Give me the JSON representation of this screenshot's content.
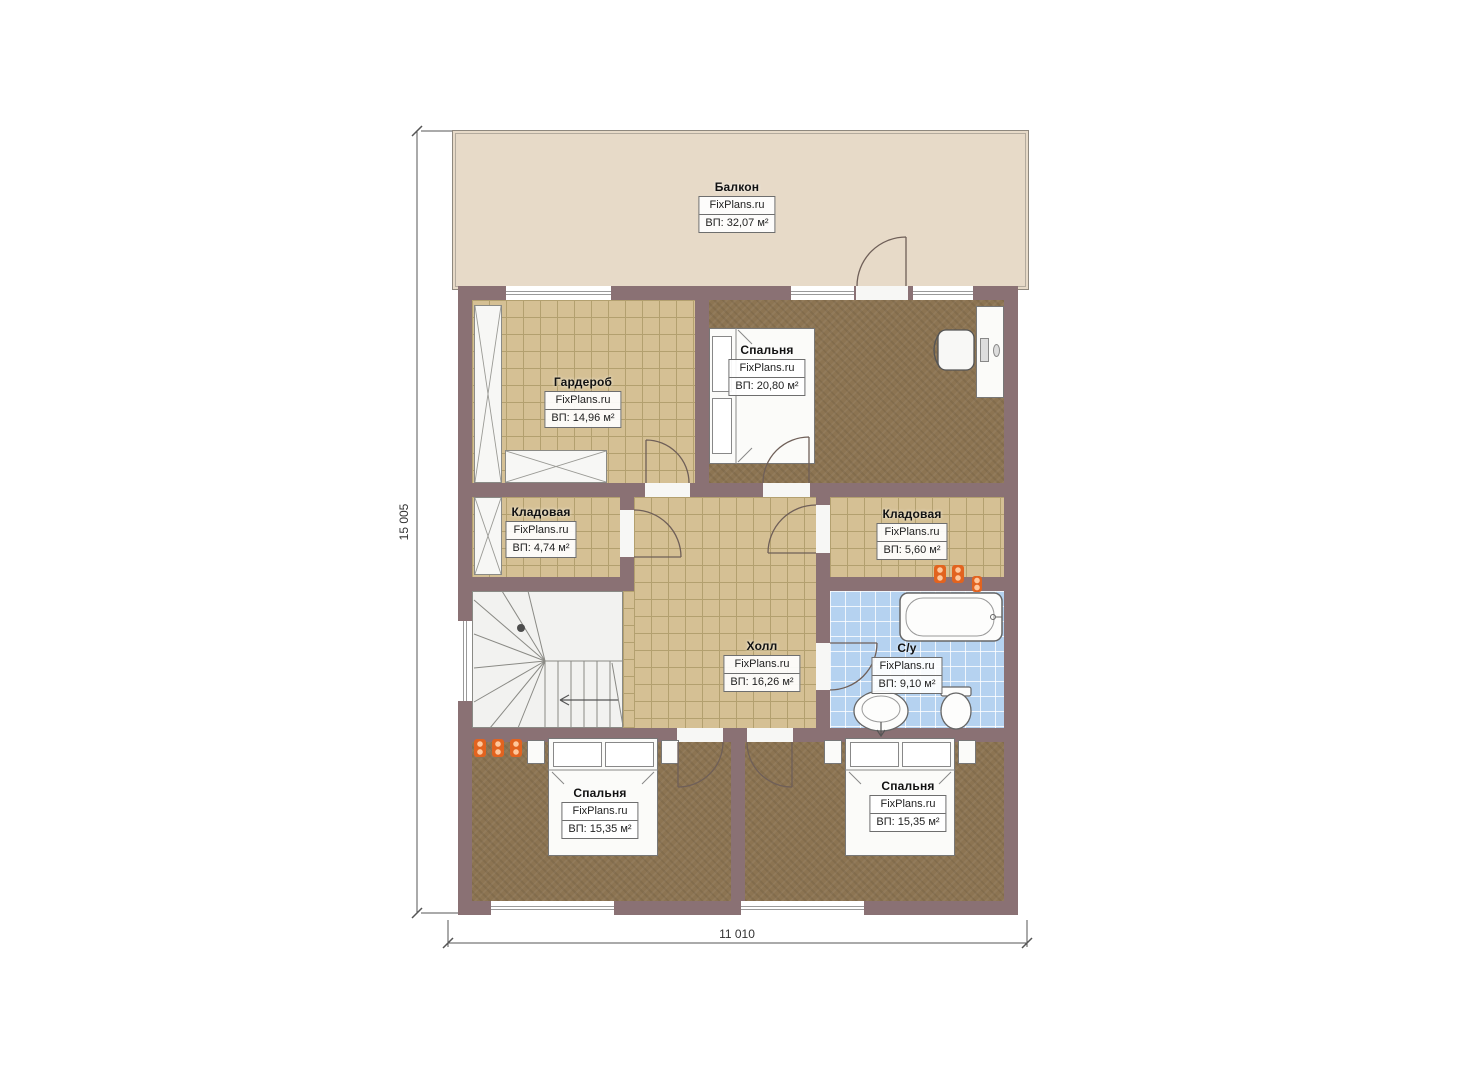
{
  "brand": "FixPlans.ru",
  "dimensions": {
    "vertical": "15 005",
    "horizontal": "11 010"
  },
  "rooms": {
    "balcony": {
      "name": "Балкон",
      "brand": "FixPlans.ru",
      "area": "ВП: 32,07 м²"
    },
    "wardrobe": {
      "name": "Гардероб",
      "brand": "FixPlans.ru",
      "area": "ВП: 14,96 м²"
    },
    "bedroom_top": {
      "name": "Спальня",
      "brand": "FixPlans.ru",
      "area": "ВП: 20,80 м²"
    },
    "storage_left": {
      "name": "Кладовая",
      "brand": "FixPlans.ru",
      "area": "ВП: 4,74 м²"
    },
    "storage_right": {
      "name": "Кладовая",
      "brand": "FixPlans.ru",
      "area": "ВП: 5,60 м²"
    },
    "hall": {
      "name": "Холл",
      "brand": "FixPlans.ru",
      "area": "ВП: 16,26 м²"
    },
    "bathroom": {
      "name": "С/у",
      "brand": "FixPlans.ru",
      "area": "ВП: 9,10 м²"
    },
    "bedroom_bottom_left": {
      "name": "Спальня",
      "brand": "FixPlans.ru",
      "area": "ВП: 15,35 м²"
    },
    "bedroom_bottom_right": {
      "name": "Спальня",
      "brand": "FixPlans.ru",
      "area": "ВП: 15,35 м²"
    }
  },
  "colors": {
    "wall": "#8a7174",
    "tile_floor": "#d5c094",
    "carpet_floor": "#8c7452",
    "bath_floor": "#b5d2f0",
    "balcony_floor": "#e7dac8",
    "accent_orange": "#e2631f"
  }
}
